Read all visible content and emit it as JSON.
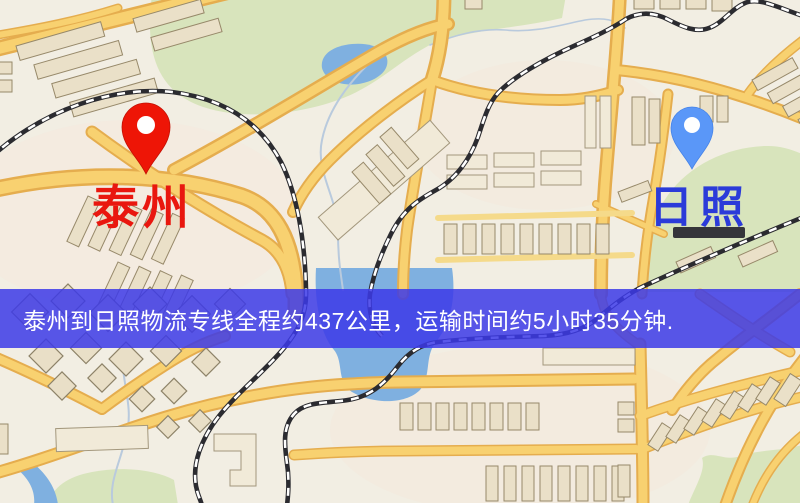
{
  "pins": [
    {
      "label": "泰州",
      "label_color": "#e9170f",
      "pin_color": "#ee1506"
    },
    {
      "label": "日照",
      "label_color": "#2b3bd9",
      "pin_color": "#5a97f8"
    }
  ],
  "banner": {
    "text": "泰州到日照物流专线全程约437公里，运输时间约5小时35分钟.",
    "bg_color": "rgba(60,58,232,0.85)",
    "text_color": "#ffffff"
  }
}
